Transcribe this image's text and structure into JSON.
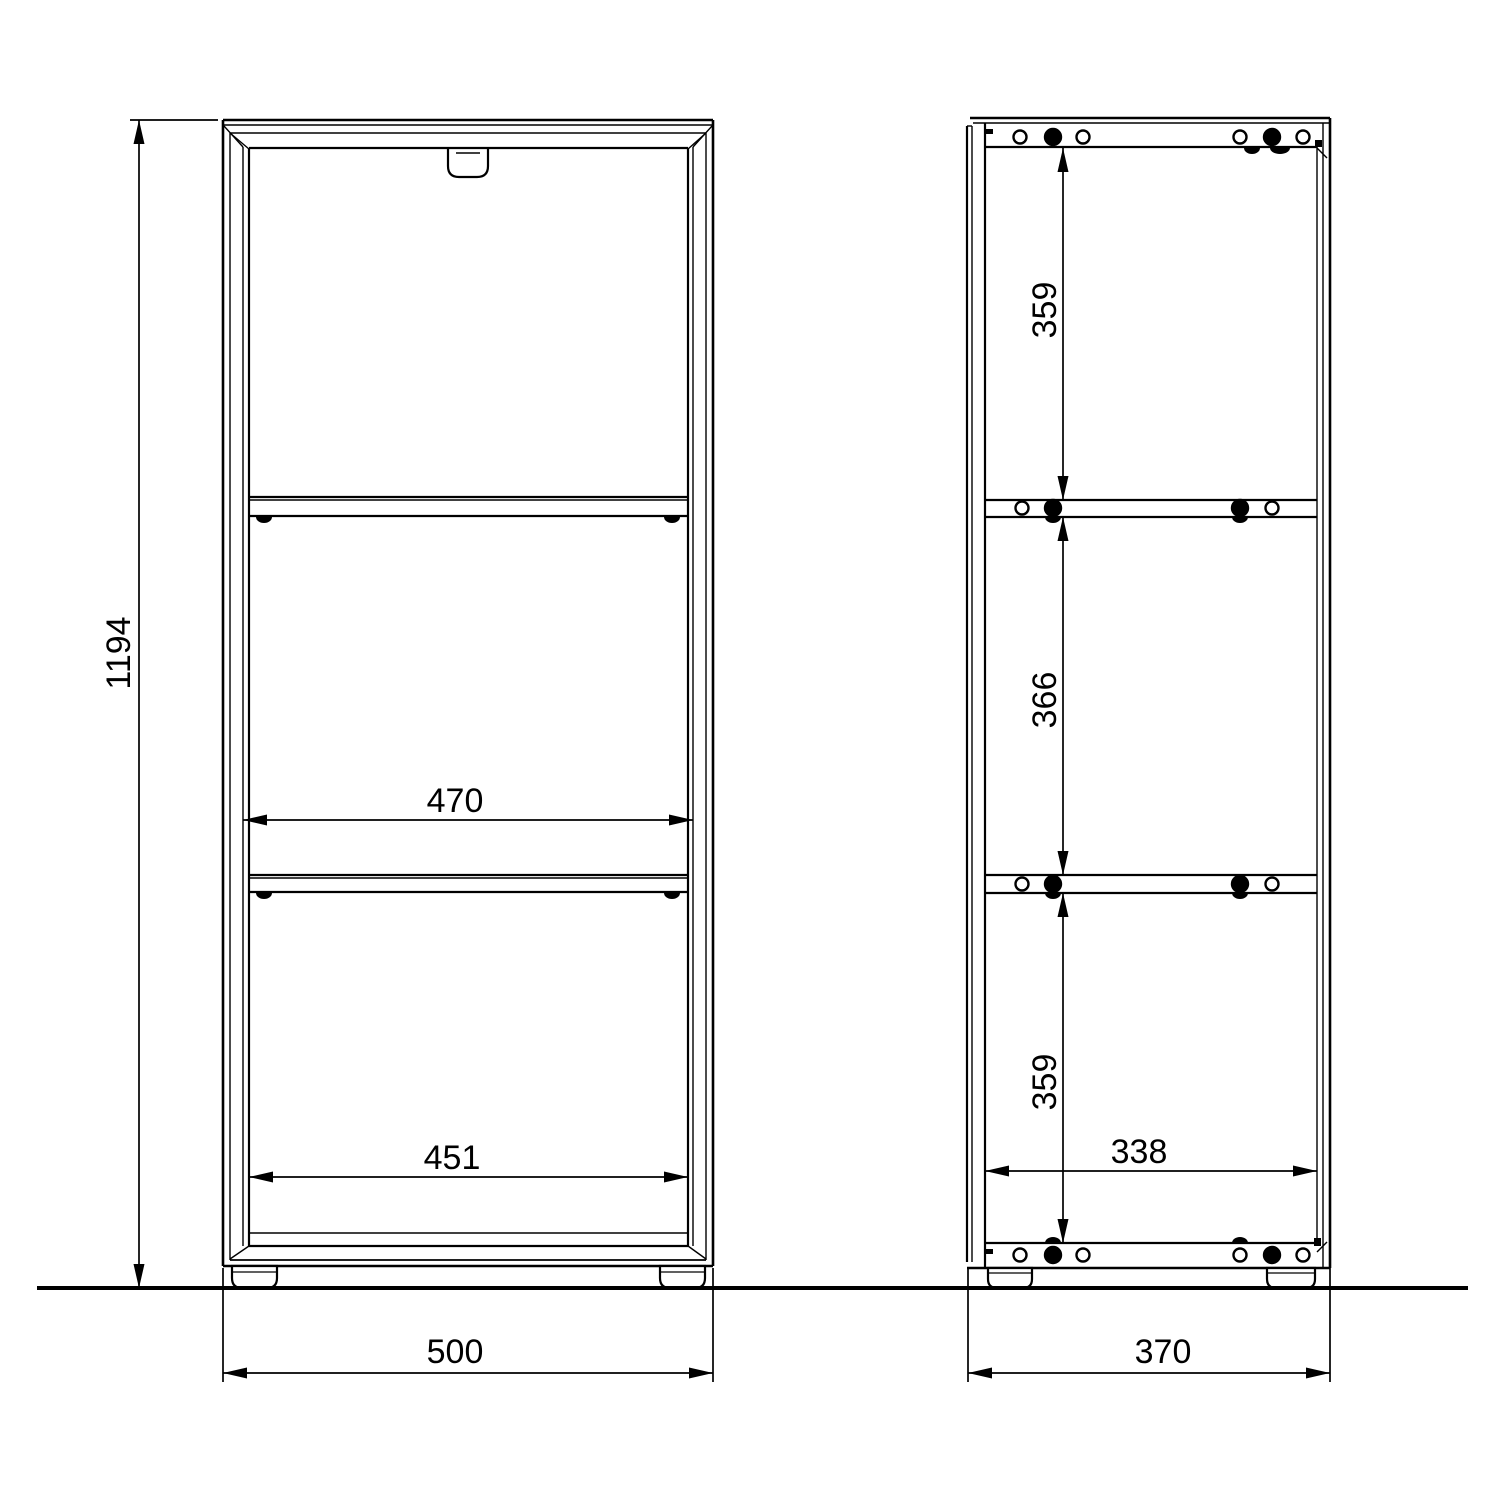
{
  "views": {
    "front": {
      "overall_height": "1194",
      "inner_width": "470",
      "door_width": "451",
      "overall_width": "500"
    },
    "side": {
      "top_compartment": "359",
      "middle_compartment": "366",
      "bottom_compartment": "359",
      "inner_depth": "338",
      "overall_depth": "370"
    }
  }
}
